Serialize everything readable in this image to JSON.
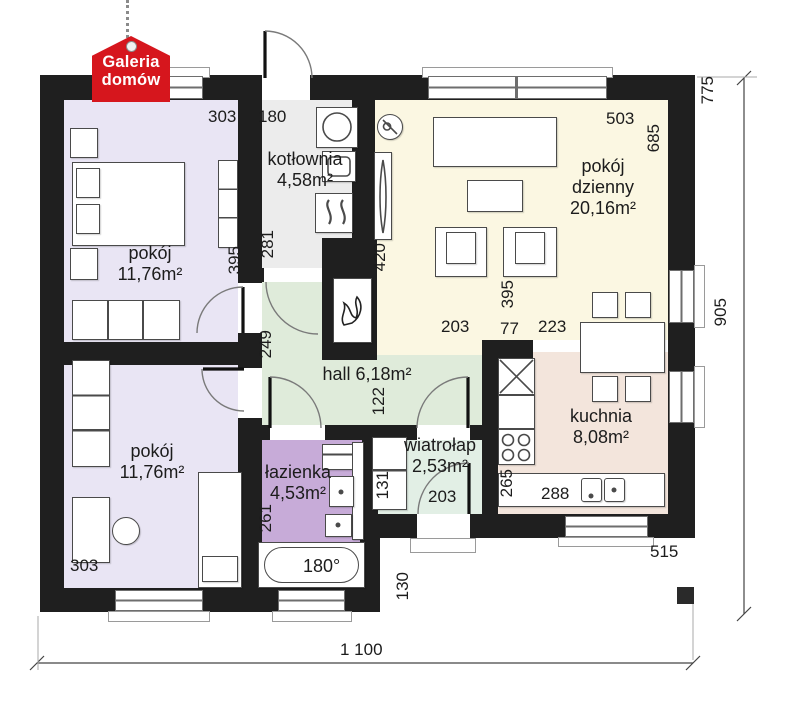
{
  "logo": {
    "line1": "Galeria",
    "line2": "domów"
  },
  "rooms": {
    "pokoj1": {
      "name": "pokój",
      "area": "11,76m²"
    },
    "kotlownia": {
      "name": "kotłownia",
      "area": "4,58m²"
    },
    "dzienny": {
      "name": "pokój dzienny",
      "area": "20,16m²"
    },
    "hall": {
      "name": "hall",
      "area": "6,18m²"
    },
    "pokoj2": {
      "name": "pokój",
      "area": "11,76m²"
    },
    "lazienka": {
      "name": "łazienka",
      "area": "4,53m²"
    },
    "wiatrolap": {
      "name": "wiatrołap",
      "area": "2,53m²"
    },
    "kuchnia": {
      "name": "kuchnia",
      "area": "8,08m²"
    }
  },
  "dimensions": {
    "pokoj1_width": "303",
    "entry_width": "180",
    "dzienny_width": "503",
    "right_upper": "775",
    "right_total": "905",
    "dzienny_height": "685",
    "pokoj1_height": "395",
    "kotlownia_height": "281",
    "radiator_height": "420",
    "hall_height": "249",
    "dzienny_lower": "395",
    "hall_right": "203",
    "wall_segment": "77",
    "kitchen_opening": "223",
    "hall_lower": "122",
    "vest_wardrobe": "131",
    "wiatrolap_width": "203",
    "kitchen_height": "265",
    "kitchen_width": "288",
    "bottom_right_width": "515",
    "entry_recess": "130",
    "lazienka_height": "261",
    "pokoj2_width": "303",
    "bathtub_length": "180°",
    "total_width": "1 100"
  },
  "colors": {
    "wall": "#1f1f1f",
    "bedroom_fill": "#e9e5f4",
    "boiler_room_fill": "#ececec",
    "living_room_fill": "#fbf7e2",
    "hall_fill": "#dfebda",
    "bathroom_fill": "#c7abd8",
    "vestibule_fill": "#e2efe5",
    "kitchen_fill": "#f3e5dc",
    "logo_red": "#d6161d"
  }
}
